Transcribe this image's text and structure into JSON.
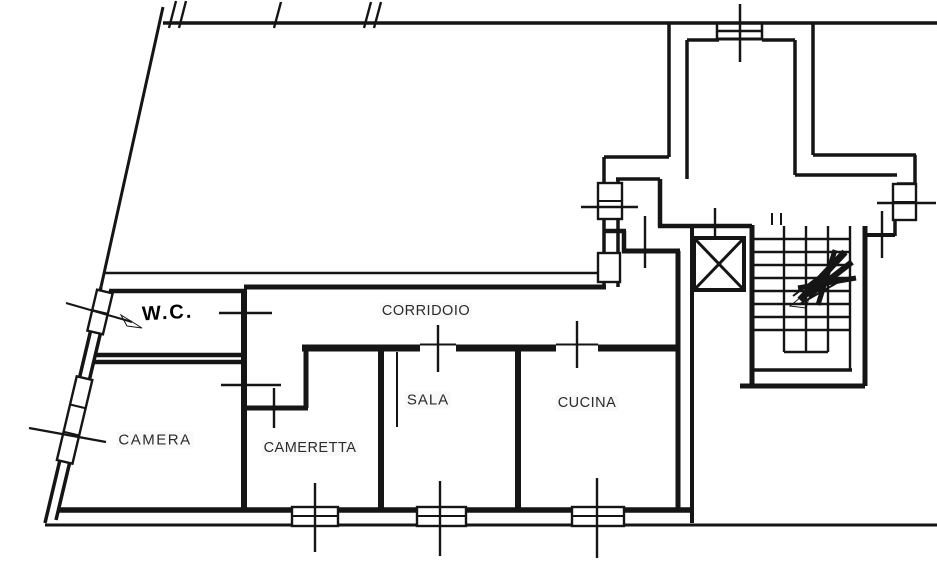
{
  "plan": {
    "type": "apartment-floor-plan",
    "rooms": {
      "wc": {
        "label": "W.C."
      },
      "corridoio": {
        "label": "CORRIDOIO"
      },
      "camera": {
        "label": "CAMERA"
      },
      "cameretta": {
        "label": "CAMERETTA"
      },
      "sala": {
        "label": "SALA"
      },
      "cucina": {
        "label": "CUCINA"
      }
    },
    "features": {
      "elevator": "elevator-shaft-x-box",
      "staircase": "staircase-with-direction-scribble",
      "door_marks": "thin tick lines crossing walls",
      "window_marks": "double-line boxes with cross ticks"
    },
    "colors": {
      "ink": "#151515",
      "paper": "#ffffff",
      "label": "#2b2b2b"
    }
  }
}
